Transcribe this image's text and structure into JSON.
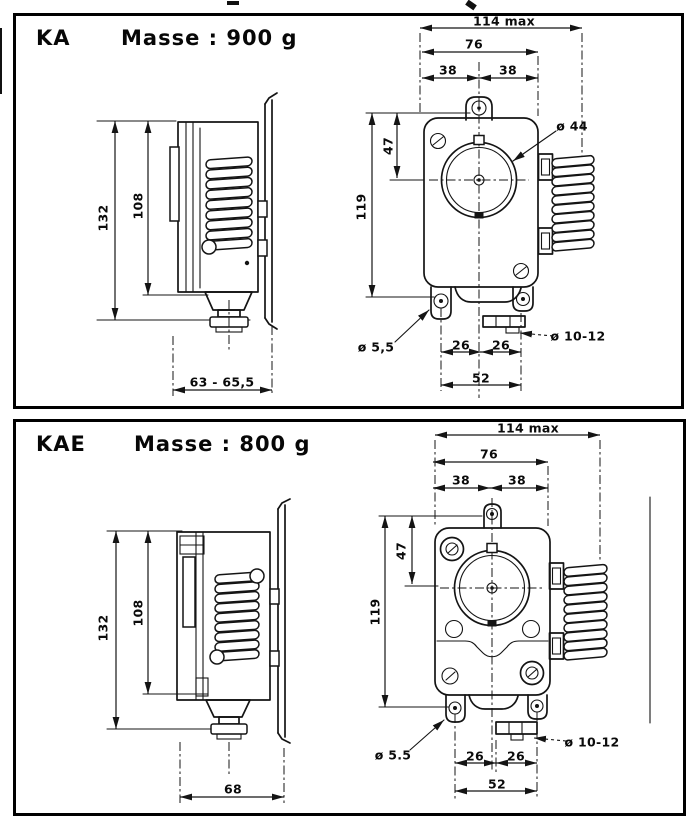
{
  "page": {
    "background": "#ffffff",
    "ink": "#141414"
  },
  "panels": [
    {
      "model": "KA",
      "mass": "Masse : 900 g",
      "dims": {
        "width_max": "114 max",
        "width_body": "76",
        "pitch_left": "38",
        "pitch_right": "38",
        "knob_offset": "47",
        "height_front": "119",
        "height_overall": "132",
        "height_body": "108",
        "depth": "63 - 65,5",
        "foot_left": "26",
        "foot_right": "26",
        "foot_span": "52"
      },
      "callouts": {
        "knob_diameter": "ø 44",
        "mount_hole": "ø 5,5",
        "gland": "ø 10-12"
      }
    },
    {
      "model": "KAE",
      "mass": "Masse : 800 g",
      "dims": {
        "width_max": "114 max",
        "width_body": "76",
        "pitch_left": "38",
        "pitch_right": "38",
        "knob_offset": "47",
        "height_front": "119",
        "height_overall": "132",
        "height_body": "108",
        "depth": "68",
        "foot_left": "26",
        "foot_right": "26",
        "foot_span": "52"
      },
      "callouts": {
        "mount_hole": "ø 5.5",
        "gland": "ø 10-12"
      }
    }
  ]
}
